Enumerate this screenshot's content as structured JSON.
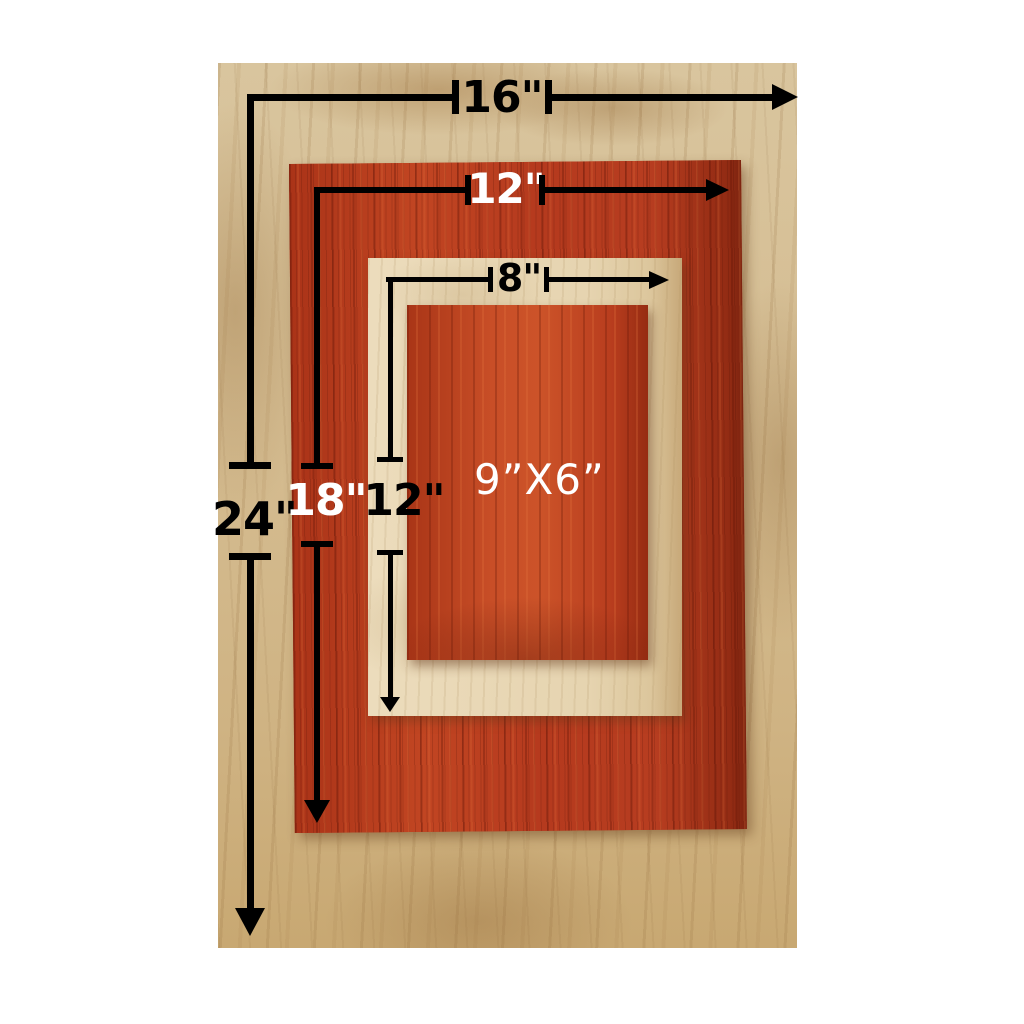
{
  "annotations": {
    "base_board_width": "16\"",
    "base_board_height": "24\"",
    "red_board_width": "12\"",
    "red_board_height": "18\"",
    "maple_board_width": "8\"",
    "maple_board_height": "12\"",
    "inner_board_size": "9”X6”"
  },
  "colors": {
    "background": "#ffffff",
    "annotation_line": "#000000",
    "label_dark": "#000000",
    "label_light": "#ffffff",
    "base_wood": "#d5bd92",
    "red_wood": "#b53a1e",
    "maple_wood": "#e6d4b0",
    "inner_red_wood": "#c04a24"
  }
}
